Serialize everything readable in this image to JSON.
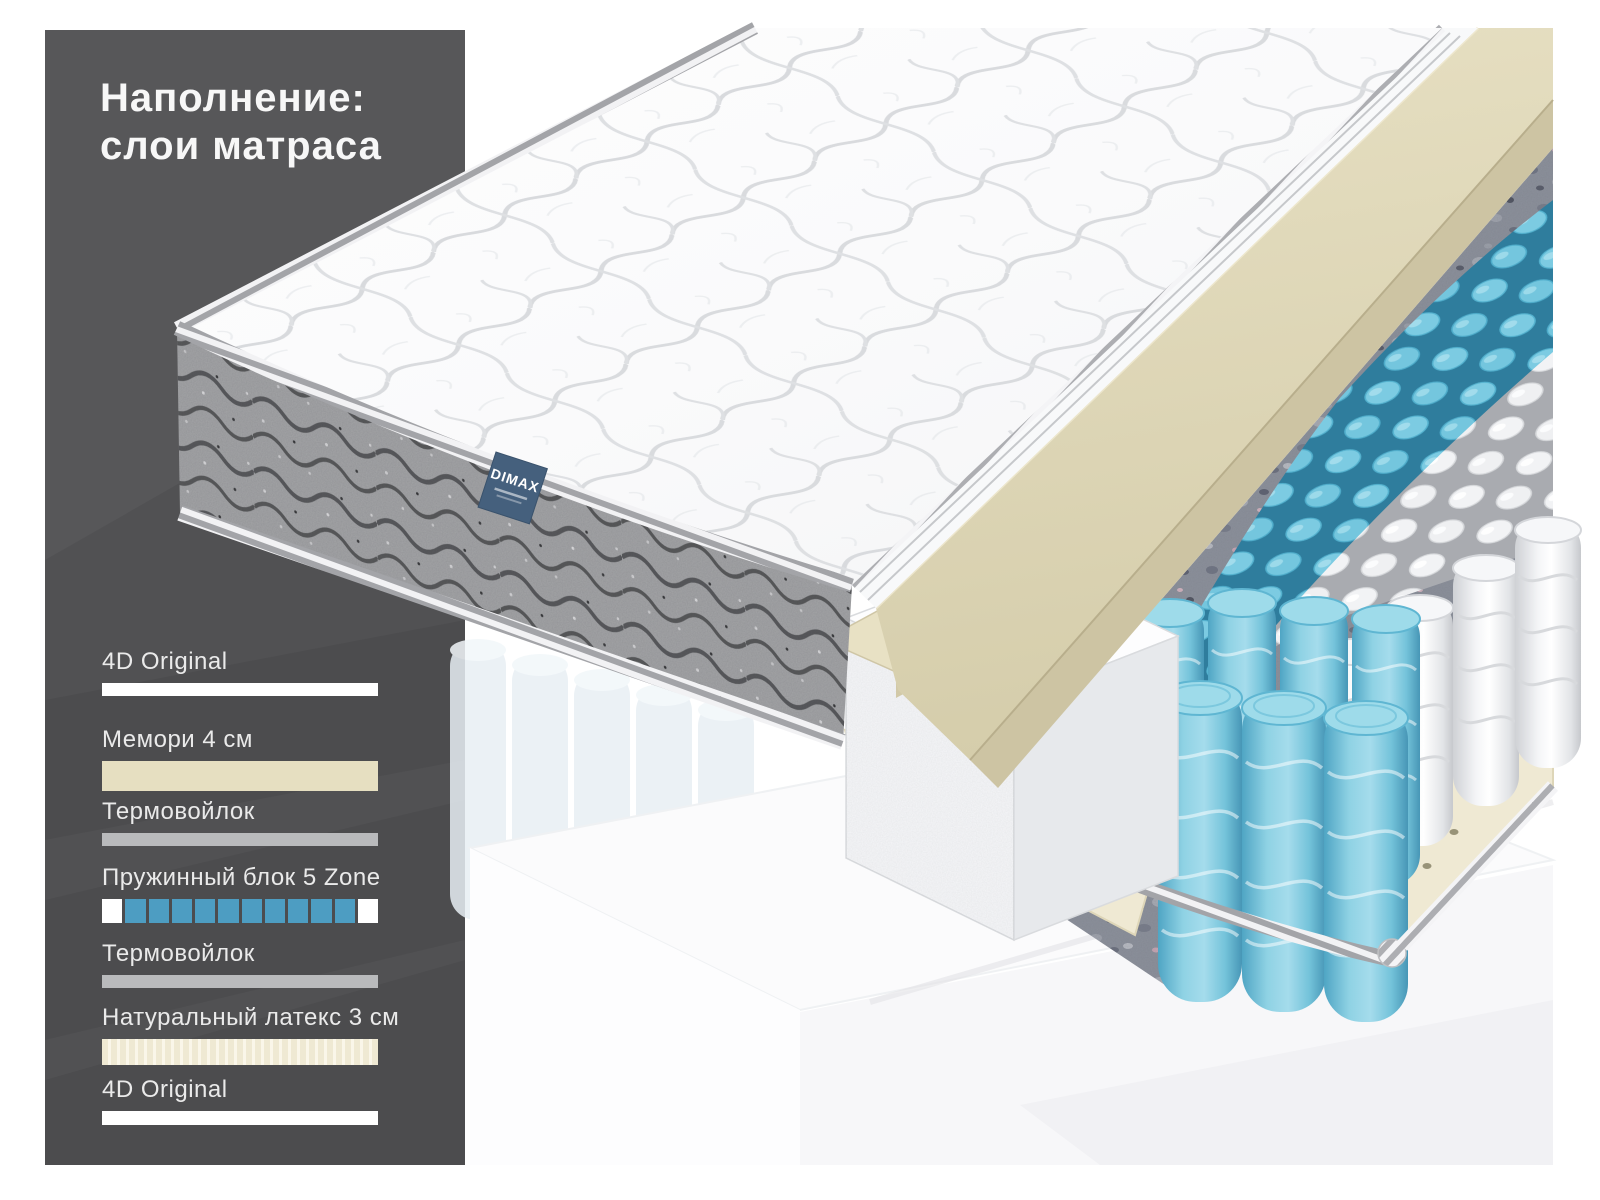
{
  "title": {
    "line1": "Наполнение:",
    "line2": "слои матраса"
  },
  "brand_label": {
    "text": "DIMAX"
  },
  "legend": {
    "items": [
      {
        "label": "4D Original",
        "swatch": "white",
        "height": 13
      },
      {
        "label": "Мемори 4 см",
        "swatch": "memory",
        "height": 30
      },
      {
        "label": "Термовойлок",
        "swatch": "gray",
        "height": 13
      },
      {
        "label": "Пружинный блок 5 Zone",
        "swatch": "springs",
        "height": 24,
        "cells": [
          "#ffffff",
          "#4d9dc2",
          "#4d9dc2",
          "#4d9dc2",
          "#4d9dc2",
          "#4d9dc2",
          "#4d9dc2",
          "#4d9dc2",
          "#4d9dc2",
          "#4d9dc2",
          "#4d9dc2",
          "#ffffff"
        ]
      },
      {
        "label": "Термовойлок",
        "swatch": "gray",
        "height": 13
      },
      {
        "label": "Натуральный латекс 3 см",
        "swatch": "latex",
        "height": 26
      },
      {
        "label": "4D Original",
        "swatch": "white",
        "height": 14
      }
    ]
  },
  "colors": {
    "panel_dark": "#515153",
    "accent_blue": "#4d9dc2",
    "memory_beige": "#e6dfc1",
    "thermofelt_gray": "#b9babc",
    "latex_cream": "#efe9d3",
    "bar_white": "#ffffff",
    "brand_navy": "#45607d",
    "spring_blue": "#7ccbe2",
    "felt_texture": "#8b909b"
  }
}
